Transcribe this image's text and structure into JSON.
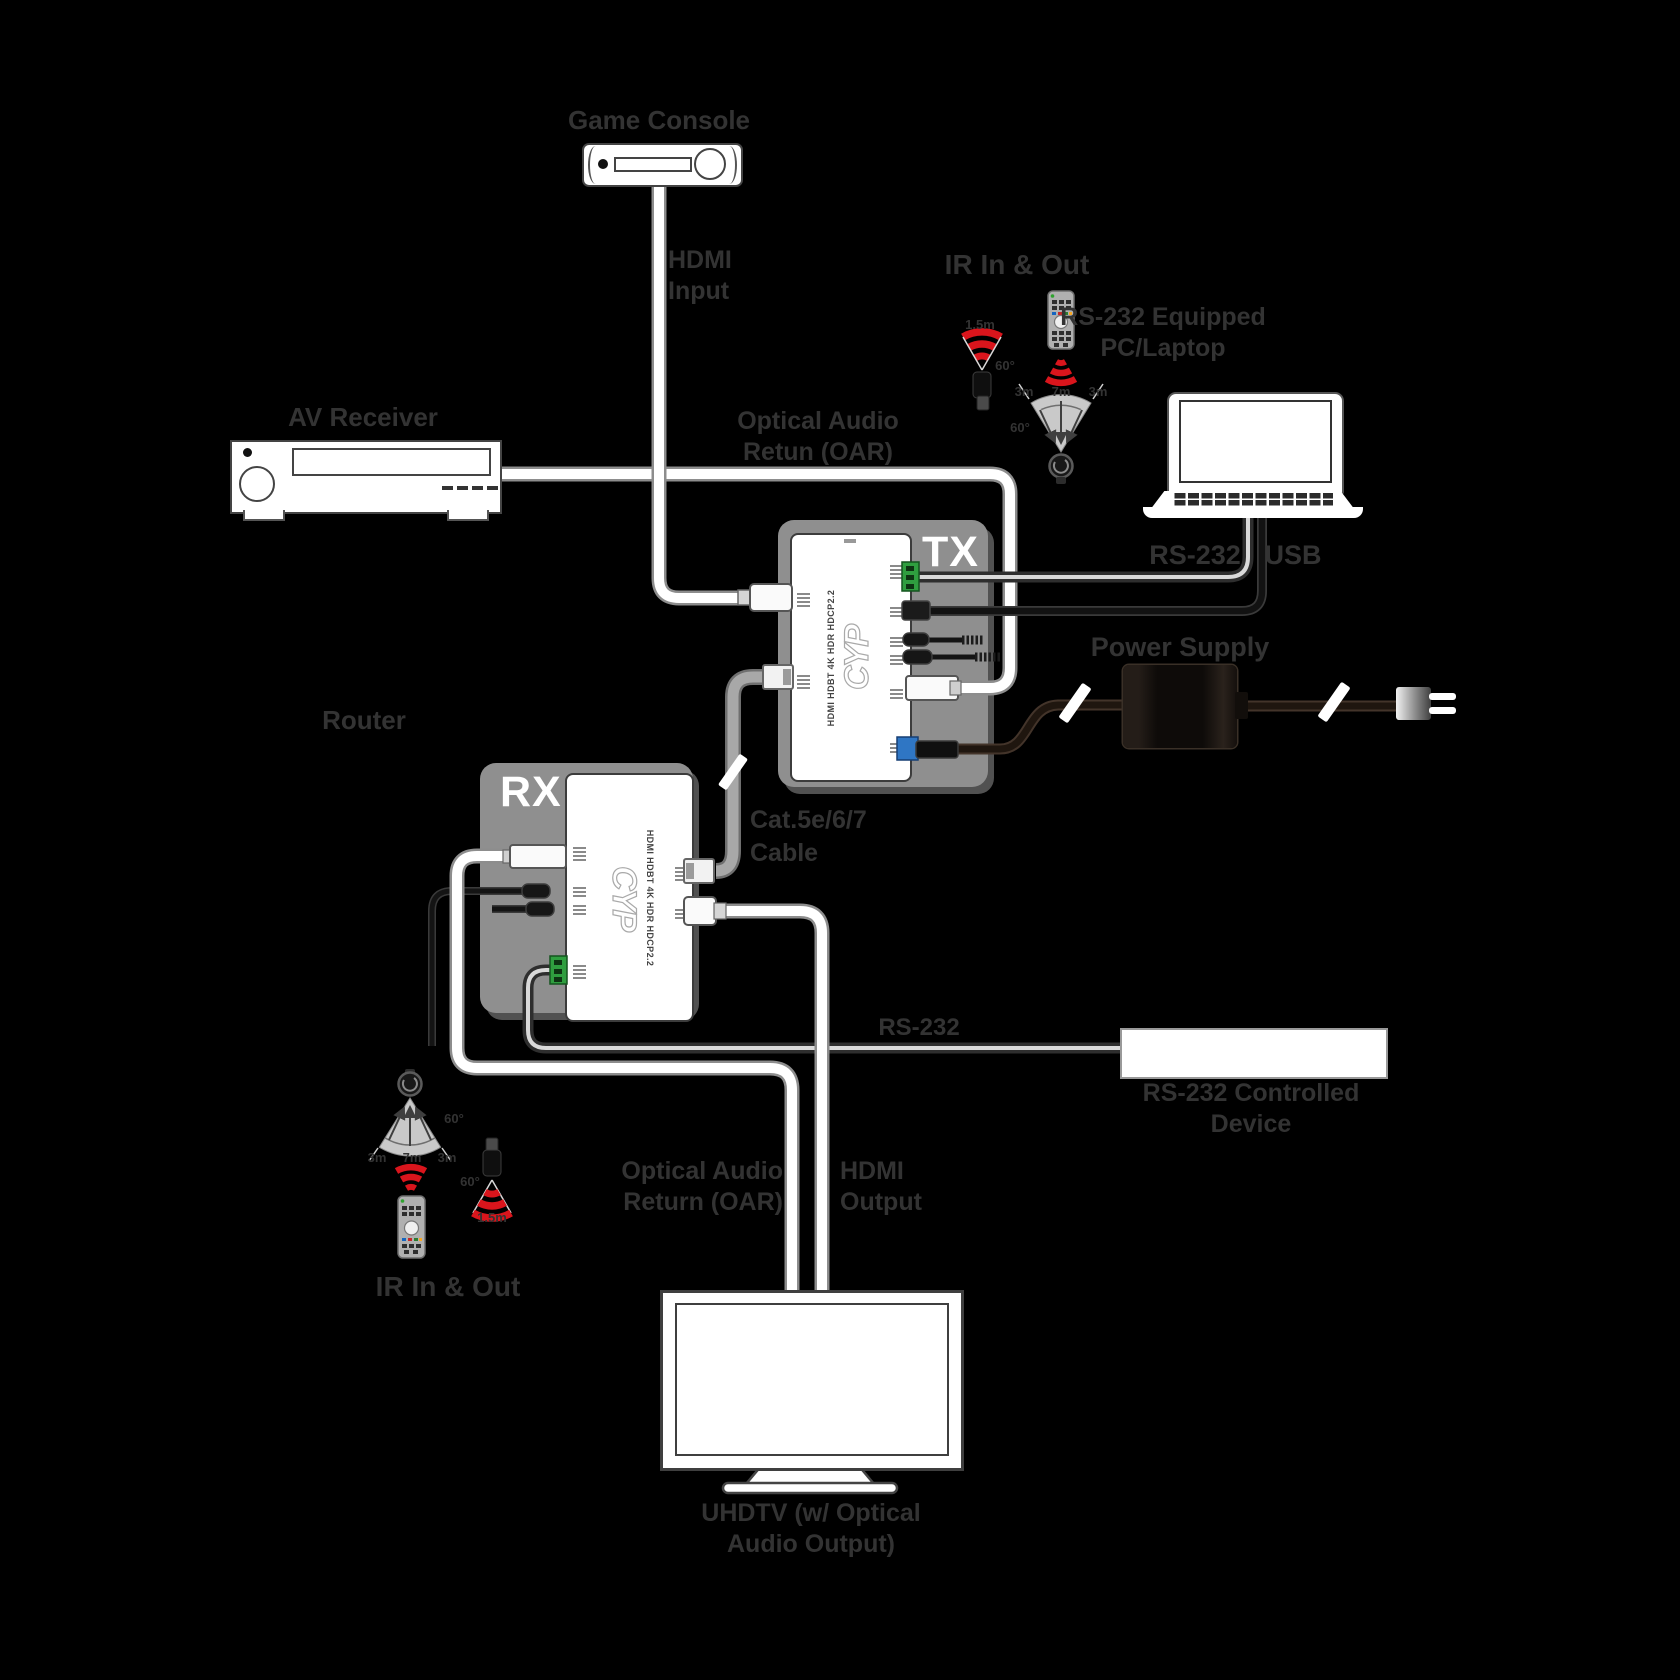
{
  "colors": {
    "ir-red": "#d9151c",
    "terminal-green": "#2f9e3f",
    "dc-blue": "#2f76c4",
    "module-gray": "#8f8f8f",
    "label": "#333333"
  },
  "nodes": {
    "game_console": {
      "label": "Game Console"
    },
    "hdmi_input": {
      "line1": "HDMI",
      "line2": "Input"
    },
    "av_receiver": {
      "label": "AV Receiver"
    },
    "oar_top": {
      "line1": "Optical Audio",
      "line2": "Retun (OAR)"
    },
    "pc": {
      "line1": "RS-232 Equipped",
      "line2": "PC/Laptop"
    },
    "rs232_top_label": "RS-232",
    "usb_label": "USB",
    "power_supply": {
      "label": "Power Supply"
    },
    "router": {
      "label": "Router"
    },
    "tx": {
      "badge": "TX",
      "logo": "CYP",
      "model": "HDMI HDBT 4K HDR HDCP2.2"
    },
    "rx": {
      "badge": "RX",
      "logo": "CYP",
      "model": "HDMI HDBT 4K HDR HDCP2.2"
    },
    "cat_cable": {
      "line1": "Cat.5e/6/7",
      "line2": "Cable"
    },
    "rs232_bottom_label": "RS-232",
    "rs232_device": {
      "line1": "RS-232 Controlled",
      "line2": "Device"
    },
    "oar_bottom": {
      "line1": "Optical Audio",
      "line2": "Return (OAR)"
    },
    "hdmi_output": {
      "line1": "HDMI",
      "line2": "Output"
    },
    "uhdtv": {
      "line1": "UHDTV (w/ Optical",
      "line2": "Audio Output)"
    },
    "ir_top": {
      "label": "IR In & Out",
      "emitter_range": "1.5m",
      "emitter_angle": "60°",
      "receiver_angle": "60°",
      "range_left": "3m",
      "range_center": "7m",
      "range_right": "3m"
    },
    "ir_bottom": {
      "label": "IR In & Out",
      "emitter_range": "1.5m",
      "emitter_angle": "60°",
      "receiver_angle": "60°",
      "range_left": "3m",
      "range_center": "7m",
      "range_right": "3m"
    }
  }
}
